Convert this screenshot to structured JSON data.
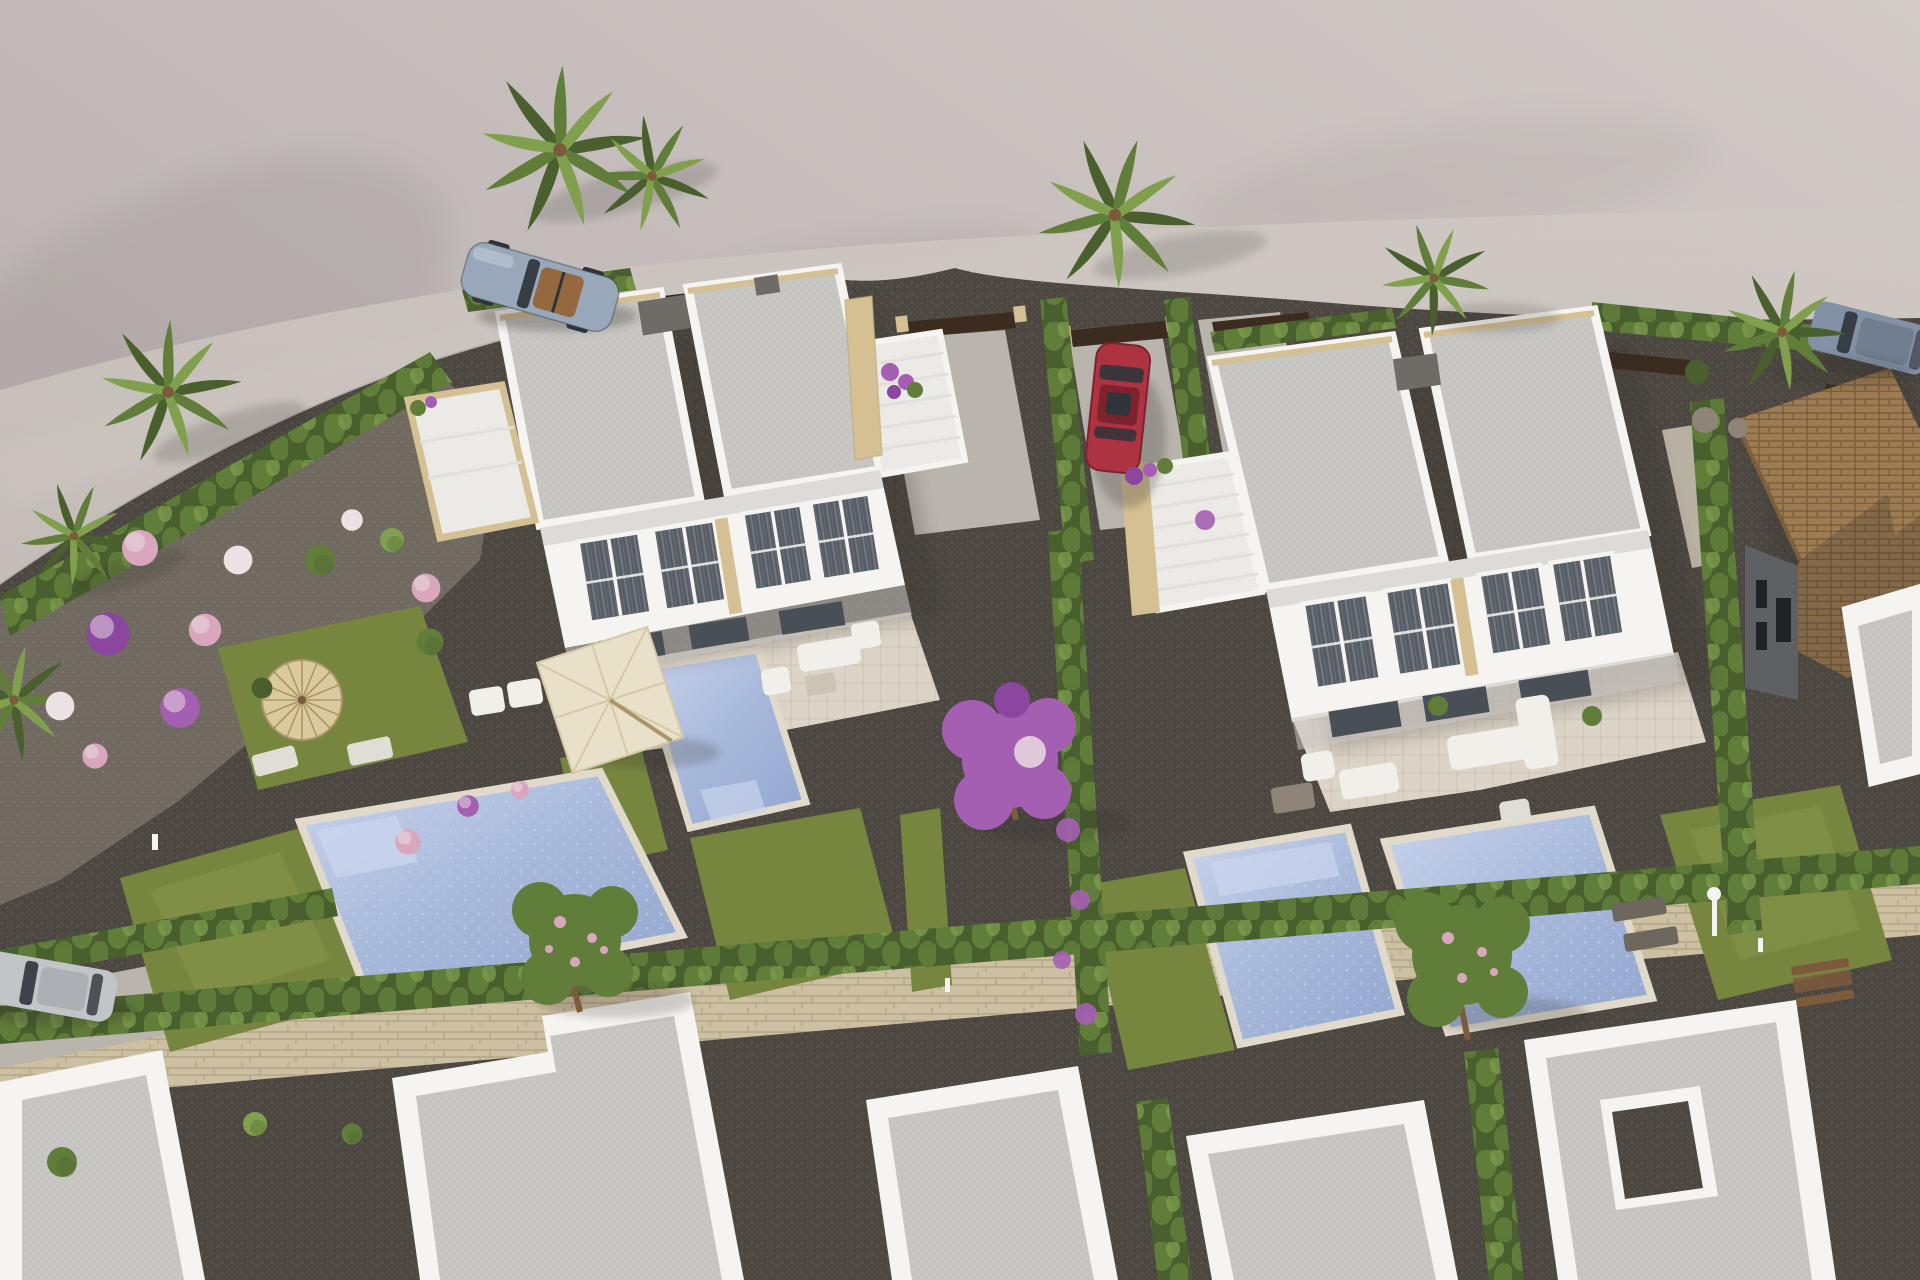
{
  "scene": {
    "type": "3d-architectural-aerial-render",
    "description": "Aerial daylight render of a modern Mediterranean residential development: two white flat-roof duplex villas with private pools, travertine terraces, hedged gardens, a curved road above, a terracotta tiled-roof house at right, and white flat rooftops along the bottom.",
    "lighting": "daylight, sun from upper left, soft shadows falling right/down",
    "counts": {
      "villas": 2,
      "pools": 4,
      "palm_trees": 8,
      "vehicles": 4,
      "parasols": 2
    },
    "vehicles": [
      {
        "kind": "convertible-sports-car",
        "color_name": "silver-blue",
        "location": "road, upper left"
      },
      {
        "kind": "sedan",
        "color_name": "red",
        "location": "driveway between hedges, center"
      },
      {
        "kind": "suv",
        "color_name": "gray-blue",
        "location": "road, upper right"
      },
      {
        "kind": "hatchback",
        "color_name": "silver",
        "location": "driveway, lower left"
      }
    ],
    "vegetation": [
      "fan palms",
      "cypress hedges",
      "flower balls pink/white/purple",
      "bougainvillea tree",
      "blossom trees",
      "lawns"
    ],
    "materials": [
      "white render walls",
      "gray gravel flat roofs",
      "travertine stone trim",
      "glass with gray curtains",
      "terracotta roof tiles",
      "dark gravel",
      "sandstone boundary wall"
    ]
  },
  "palette": {
    "terrainLight": "#d1cac7",
    "terrainMid": "#b2aaa9",
    "road1": "#c3bcb7",
    "road2": "#cfc8c3",
    "roadEdge": "#9f968f",
    "gravelDark": "#4d4842",
    "gravelDot": "#5d574f",
    "gravelMid": "#716a60",
    "gravelMidDot": "#837b6f",
    "pathLight": "#c4bcae",
    "concrete": "#b9b4ac",
    "stoneWall": "#cdc0a2",
    "stoneWallLine": "#b3a585",
    "wallWhite": "#f5f4f1",
    "wallShade": "#e2e0dc",
    "wallDark": "#c9c7c3",
    "roofSlab": "#c7c6c3",
    "roofDot": "#bab9b6",
    "stone": "#d5c094",
    "stoneDark": "#bfa97c",
    "terraceFloor": "#dbd4c7",
    "terraceLine": "#ccc4b5",
    "stairLight": "#eceae6",
    "windowDark": "#575d65",
    "windowStripe": "#7e848c",
    "doorDark": "#494f57",
    "grass": "#77863f",
    "grassLight": "#8d9c50",
    "greenDark": "#49602e",
    "greenMid": "#617d3a",
    "greenLight": "#81a04e",
    "water": "#a7b8da",
    "waterLight": "#c9d4ec",
    "waterDeep": "#92a6cf",
    "poolEdge": "#e1dacb",
    "umbCream": "#e9e0c9",
    "umbRib": "#d5c8a6",
    "straw": "#dbca9d",
    "strawRib": "#ab9668",
    "sofa": "#f1efe9",
    "cushion": "#e0ddd4",
    "deckDark": "#6e675d",
    "woodBrown": "#7c5b3c",
    "gateBrown": "#3c2c20",
    "acGray": "#6f6c68",
    "carRed": "#ad3340",
    "carRedDark": "#7e222e",
    "carSilver": "#98a7ba",
    "carSilverLight": "#c9d2dd",
    "carGray": "#8291a5",
    "carPale": "#c2c5c8",
    "cabin": "#2f343a",
    "seatTan": "#96683f",
    "purple": "#a55fb2",
    "purpleDeep": "#8b46a0",
    "pink": "#d9a6be",
    "bloomWhite": "#ece2e4",
    "tile": "#9d7b53",
    "tileDark": "#7d5e3d",
    "darkWall": "#5e6064",
    "blackWin": "#202225",
    "rock": "#8e8578",
    "shadow": "#2e2a26"
  }
}
